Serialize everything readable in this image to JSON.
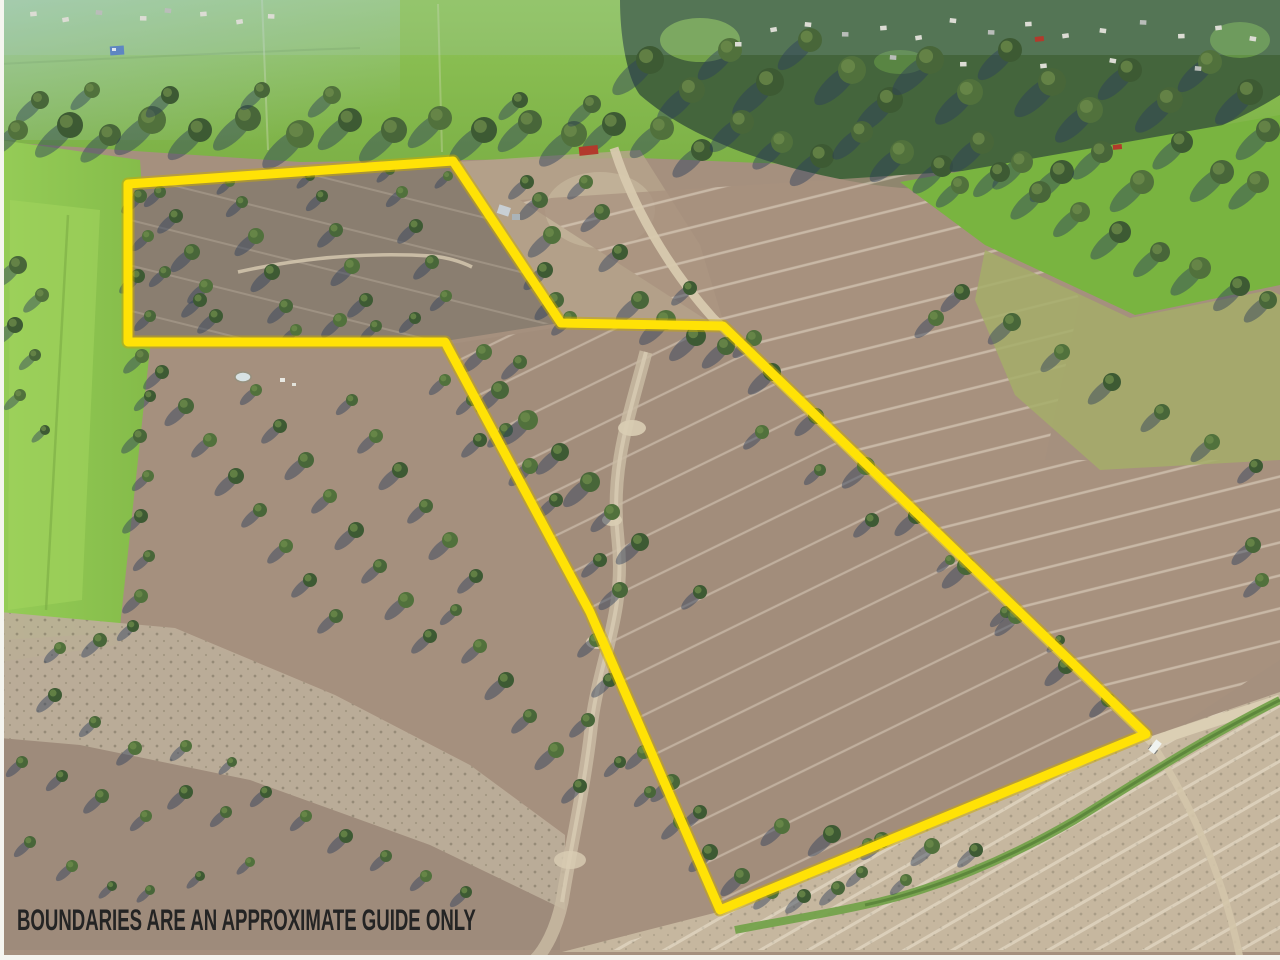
{
  "caption": {
    "text": "BOUNDARIES ARE AN APPROXIMATE GUIDE ONLY",
    "color": "#242424"
  },
  "boundary": {
    "color": "#ffe206",
    "under_color": "#c9a900",
    "stroke_width": 9,
    "points": "128,184 453,161 561,323 723,326 1146,734 720,910 590,612 445,342 128,342"
  },
  "scene": {
    "palette": {
      "field_base": "#a5907e",
      "field_gray": "#8a7e70",
      "field_pink": "#a8917f",
      "field_lower": "#a18c7a",
      "green_strip": "#8cc453",
      "green_bright": "#79b440",
      "green_olive": "#a4ad68",
      "green_topband": "#86bd4e",
      "tree_dark": "#3d5a33",
      "tree_mid": "#486639",
      "tree_light": "#51713c",
      "tree_highlight": "#6d8c4b",
      "shadow": "rgba(44,62,92,0.45)",
      "gravel": "#bdaf9a",
      "gravel_light": "#c6b79f",
      "road": "#d7c9ae",
      "channel_green": "#74a24b",
      "edge_white": "#f5f5f0"
    },
    "trees": [
      [
        70,
        125,
        13
      ],
      [
        110,
        135,
        11
      ],
      [
        152,
        120,
        14
      ],
      [
        200,
        130,
        12
      ],
      [
        248,
        118,
        13
      ],
      [
        300,
        134,
        14
      ],
      [
        350,
        120,
        12
      ],
      [
        394,
        130,
        13
      ],
      [
        440,
        118,
        12
      ],
      [
        484,
        130,
        13
      ],
      [
        530,
        122,
        12
      ],
      [
        574,
        134,
        13
      ],
      [
        614,
        124,
        12
      ],
      [
        40,
        100,
        9
      ],
      [
        92,
        90,
        8
      ],
      [
        170,
        95,
        9
      ],
      [
        262,
        90,
        8
      ],
      [
        332,
        95,
        9
      ],
      [
        520,
        100,
        8
      ],
      [
        592,
        104,
        9
      ],
      [
        18,
        130,
        10
      ],
      [
        650,
        60,
        14
      ],
      [
        692,
        90,
        13
      ],
      [
        730,
        50,
        12
      ],
      [
        770,
        82,
        14
      ],
      [
        810,
        40,
        12
      ],
      [
        852,
        70,
        14
      ],
      [
        890,
        100,
        13
      ],
      [
        930,
        60,
        14
      ],
      [
        970,
        92,
        13
      ],
      [
        1010,
        50,
        12
      ],
      [
        1052,
        82,
        14
      ],
      [
        1090,
        110,
        13
      ],
      [
        1130,
        70,
        12
      ],
      [
        1170,
        100,
        13
      ],
      [
        1210,
        62,
        12
      ],
      [
        1250,
        92,
        13
      ],
      [
        1268,
        130,
        12
      ],
      [
        662,
        128,
        12
      ],
      [
        702,
        150,
        11
      ],
      [
        742,
        122,
        12
      ],
      [
        782,
        142,
        11
      ],
      [
        822,
        156,
        12
      ],
      [
        862,
        132,
        11
      ],
      [
        902,
        152,
        12
      ],
      [
        942,
        166,
        11
      ],
      [
        982,
        142,
        12
      ],
      [
        1022,
        162,
        11
      ],
      [
        1062,
        172,
        12
      ],
      [
        1102,
        152,
        11
      ],
      [
        1142,
        182,
        12
      ],
      [
        1182,
        142,
        11
      ],
      [
        1222,
        172,
        12
      ],
      [
        1258,
        182,
        11
      ],
      [
        1000,
        172,
        10
      ],
      [
        1040,
        192,
        11
      ],
      [
        1080,
        212,
        10
      ],
      [
        1120,
        232,
        11
      ],
      [
        1160,
        252,
        10
      ],
      [
        1200,
        268,
        11
      ],
      [
        1240,
        286,
        10
      ],
      [
        1268,
        300,
        9
      ],
      [
        960,
        185,
        9
      ],
      [
        962,
        292,
        8
      ],
      [
        1012,
        322,
        9
      ],
      [
        1062,
        352,
        8
      ],
      [
        1112,
        382,
        9
      ],
      [
        1162,
        412,
        8
      ],
      [
        1212,
        442,
        8
      ],
      [
        1256,
        466,
        7
      ],
      [
        640,
        300,
        9
      ],
      [
        666,
        320,
        10
      ],
      [
        696,
        336,
        10
      ],
      [
        726,
        346,
        9
      ],
      [
        754,
        338,
        8
      ],
      [
        620,
        252,
        8
      ],
      [
        602,
        212,
        8
      ],
      [
        586,
        182,
        7
      ],
      [
        690,
        288,
        7
      ],
      [
        540,
        200,
        8
      ],
      [
        552,
        235,
        9
      ],
      [
        545,
        270,
        8
      ],
      [
        556,
        300,
        8
      ],
      [
        570,
        318,
        7
      ],
      [
        527,
        182,
        7
      ],
      [
        160,
        192,
        6
      ],
      [
        230,
        182,
        5
      ],
      [
        310,
        176,
        5
      ],
      [
        390,
        170,
        5
      ],
      [
        448,
        176,
        5
      ],
      [
        176,
        216,
        7
      ],
      [
        192,
        252,
        8
      ],
      [
        206,
        286,
        7
      ],
      [
        216,
        316,
        7
      ],
      [
        242,
        202,
        6
      ],
      [
        256,
        236,
        8
      ],
      [
        272,
        272,
        8
      ],
      [
        286,
        306,
        7
      ],
      [
        296,
        330,
        6
      ],
      [
        322,
        196,
        6
      ],
      [
        336,
        230,
        7
      ],
      [
        352,
        266,
        8
      ],
      [
        366,
        300,
        7
      ],
      [
        376,
        326,
        6
      ],
      [
        402,
        192,
        6
      ],
      [
        416,
        226,
        7
      ],
      [
        432,
        262,
        7
      ],
      [
        446,
        296,
        6
      ],
      [
        200,
        300,
        7
      ],
      [
        165,
        272,
        6
      ],
      [
        340,
        320,
        7
      ],
      [
        415,
        318,
        6
      ],
      [
        18,
        265,
        9
      ],
      [
        42,
        295,
        7
      ],
      [
        15,
        325,
        8
      ],
      [
        35,
        355,
        6
      ],
      [
        20,
        395,
        6
      ],
      [
        45,
        430,
        5
      ],
      [
        140,
        196,
        7
      ],
      [
        148,
        236,
        6
      ],
      [
        138,
        276,
        7
      ],
      [
        150,
        316,
        6
      ],
      [
        142,
        356,
        7
      ],
      [
        150,
        396,
        6
      ],
      [
        140,
        436,
        7
      ],
      [
        148,
        476,
        6
      ],
      [
        141,
        516,
        7
      ],
      [
        149,
        556,
        6
      ],
      [
        141,
        596,
        7
      ],
      [
        133,
        626,
        6
      ],
      [
        100,
        640,
        7
      ],
      [
        60,
        648,
        6
      ],
      [
        162,
        372,
        7
      ],
      [
        186,
        406,
        8
      ],
      [
        210,
        440,
        7
      ],
      [
        236,
        476,
        8
      ],
      [
        260,
        510,
        7
      ],
      [
        286,
        546,
        7
      ],
      [
        310,
        580,
        7
      ],
      [
        336,
        616,
        7
      ],
      [
        256,
        390,
        6
      ],
      [
        280,
        426,
        7
      ],
      [
        306,
        460,
        8
      ],
      [
        330,
        496,
        7
      ],
      [
        356,
        530,
        8
      ],
      [
        380,
        566,
        7
      ],
      [
        406,
        600,
        8
      ],
      [
        430,
        636,
        7
      ],
      [
        352,
        400,
        6
      ],
      [
        376,
        436,
        7
      ],
      [
        400,
        470,
        8
      ],
      [
        426,
        506,
        7
      ],
      [
        450,
        540,
        8
      ],
      [
        476,
        576,
        7
      ],
      [
        456,
        610,
        6
      ],
      [
        480,
        646,
        7
      ],
      [
        506,
        680,
        8
      ],
      [
        530,
        716,
        7
      ],
      [
        556,
        750,
        8
      ],
      [
        580,
        786,
        7
      ],
      [
        506,
        430,
        7
      ],
      [
        530,
        466,
        8
      ],
      [
        556,
        500,
        7
      ],
      [
        472,
        400,
        6
      ],
      [
        445,
        380,
        6
      ],
      [
        480,
        440,
        7
      ],
      [
        500,
        390,
        9
      ],
      [
        528,
        420,
        10
      ],
      [
        560,
        452,
        9
      ],
      [
        590,
        482,
        10
      ],
      [
        612,
        512,
        8
      ],
      [
        640,
        542,
        9
      ],
      [
        520,
        362,
        7
      ],
      [
        484,
        352,
        8
      ],
      [
        600,
        560,
        7
      ],
      [
        620,
        590,
        8
      ],
      [
        596,
        640,
        7
      ],
      [
        610,
        680,
        7
      ],
      [
        588,
        720,
        7
      ],
      [
        936,
        318,
        8
      ],
      [
        872,
        520,
        7
      ],
      [
        1006,
        612,
        6
      ],
      [
        762,
        432,
        7
      ],
      [
        700,
        592,
        7
      ],
      [
        820,
        470,
        6
      ],
      [
        950,
        560,
        5
      ],
      [
        1060,
        640,
        5
      ],
      [
        1253,
        545,
        8
      ],
      [
        1262,
        580,
        7
      ],
      [
        772,
        372,
        9
      ],
      [
        816,
        416,
        8
      ],
      [
        866,
        466,
        9
      ],
      [
        916,
        516,
        8
      ],
      [
        966,
        566,
        9
      ],
      [
        1016,
        616,
        8
      ],
      [
        1066,
        666,
        8
      ],
      [
        1108,
        700,
        7
      ],
      [
        782,
        826,
        8
      ],
      [
        832,
        834,
        9
      ],
      [
        882,
        840,
        8
      ],
      [
        932,
        846,
        8
      ],
      [
        976,
        850,
        7
      ],
      [
        862,
        872,
        6
      ],
      [
        906,
        880,
        6
      ],
      [
        700,
        812,
        7
      ],
      [
        672,
        782,
        8
      ],
      [
        644,
        752,
        7
      ],
      [
        620,
        762,
        6
      ],
      [
        650,
        792,
        6
      ],
      [
        680,
        822,
        7
      ],
      [
        710,
        852,
        8
      ],
      [
        742,
        876,
        8
      ],
      [
        772,
        892,
        7
      ],
      [
        804,
        896,
        7
      ],
      [
        838,
        888,
        7
      ],
      [
        868,
        844,
        6
      ],
      [
        55,
        695,
        7
      ],
      [
        95,
        722,
        6
      ],
      [
        135,
        748,
        7
      ],
      [
        62,
        776,
        6
      ],
      [
        102,
        796,
        7
      ],
      [
        146,
        816,
        6
      ],
      [
        186,
        792,
        7
      ],
      [
        226,
        812,
        6
      ],
      [
        186,
        746,
        6
      ],
      [
        266,
        792,
        6
      ],
      [
        232,
        762,
        5
      ],
      [
        306,
        816,
        6
      ],
      [
        346,
        836,
        7
      ],
      [
        386,
        856,
        6
      ],
      [
        426,
        876,
        6
      ],
      [
        466,
        892,
        6
      ],
      [
        30,
        842,
        6
      ],
      [
        72,
        866,
        6
      ],
      [
        112,
        886,
        5
      ],
      [
        22,
        762,
        6
      ],
      [
        250,
        862,
        5
      ],
      [
        200,
        876,
        5
      ],
      [
        150,
        890,
        5
      ]
    ],
    "buildings": [
      [
        770,
        28
      ],
      [
        805,
        22
      ],
      [
        842,
        32
      ],
      [
        880,
        26
      ],
      [
        915,
        36
      ],
      [
        950,
        18
      ],
      [
        988,
        30
      ],
      [
        1025,
        22
      ],
      [
        1062,
        34
      ],
      [
        1100,
        28
      ],
      [
        1140,
        20
      ],
      [
        1178,
        34
      ],
      [
        1215,
        26
      ],
      [
        1250,
        36
      ],
      [
        890,
        55
      ],
      [
        960,
        62
      ],
      [
        1040,
        64
      ],
      [
        1110,
        58
      ],
      [
        1195,
        66
      ],
      [
        735,
        42
      ],
      [
        30,
        12
      ],
      [
        62,
        18
      ],
      [
        96,
        10
      ],
      [
        140,
        16
      ],
      [
        200,
        12
      ],
      [
        236,
        20
      ],
      [
        165,
        8
      ],
      [
        268,
        14
      ]
    ],
    "red_roofs": [
      [
        588,
        150
      ],
      [
        1122,
        148
      ],
      [
        1044,
        40
      ]
    ]
  }
}
